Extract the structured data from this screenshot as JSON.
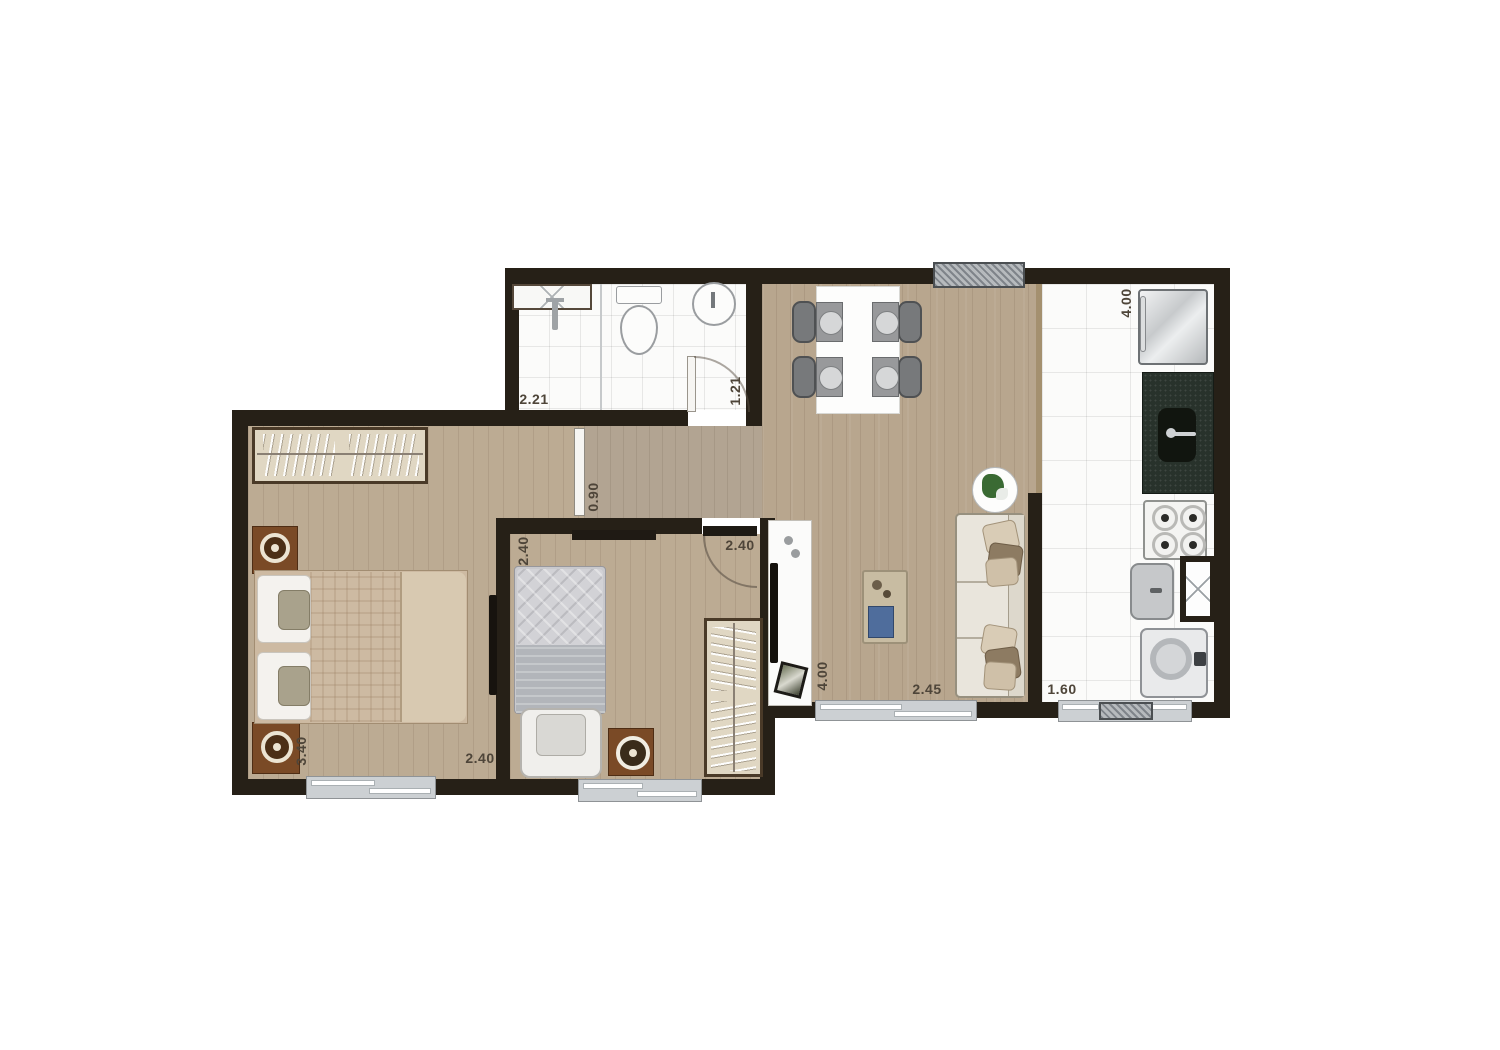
{
  "document": {
    "type": "apartment-floor-plan",
    "background": "#ffffff"
  },
  "palette": {
    "wall": "#262017",
    "wood_floor": "#b8a68e",
    "tile_floor": "#fbfbfa",
    "window_glass": "#ccd0d3",
    "hatched_window": "#7f848a",
    "dimension_text": "#4e4539",
    "counter_granite": "#28322b",
    "nightstand_brown": "#7a4a26",
    "furniture_beige": "#e0d7c3",
    "sofa_fabric": "#e9e5dc",
    "cushion_brown": "#8d7b62"
  },
  "dimensions": {
    "bathroom": {
      "width": "2.21",
      "depth": "1.21"
    },
    "kitchen": {
      "depth": "4.00"
    },
    "laundry": {
      "width": "1.60"
    },
    "hall": {
      "width": "0.90"
    },
    "bedroom2": {
      "depth": "2.40",
      "width": "2.40"
    },
    "master_bedroom": {
      "depth": "3.40",
      "width": "2.40"
    },
    "living": {
      "depth": "4.00",
      "width": "2.45"
    }
  }
}
